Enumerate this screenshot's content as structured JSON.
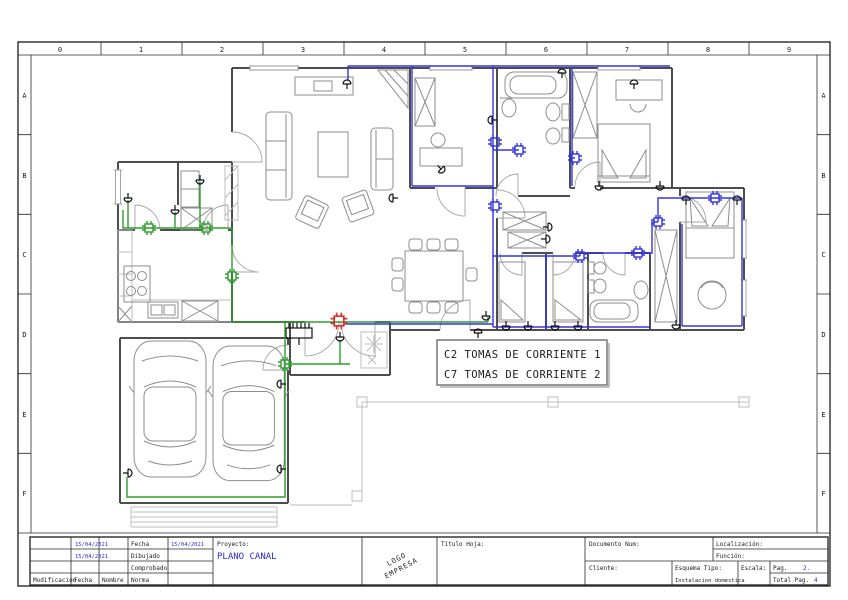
{
  "ruler": {
    "cols": [
      "0",
      "1",
      "2",
      "3",
      "4",
      "5",
      "6",
      "7",
      "8",
      "9"
    ],
    "rows": [
      "A",
      "B",
      "C",
      "D",
      "E",
      "F"
    ]
  },
  "legend": {
    "lines": [
      {
        "text": "C2 TOMAS DE CORRIENTE 1",
        "color": "#2e9e2e"
      },
      {
        "text": "C7 TOMAS DE CORRIENTE 2",
        "color": "#3535dd"
      }
    ]
  },
  "colors": {
    "circuit_c2": "#2e9e2e",
    "circuit_c7": "#3535dd",
    "panel_marker": "#d63030",
    "accent_blue": "#2a2ad4"
  },
  "title_block": {
    "revision": {
      "col_headers": [
        "Modificación",
        "Fecha",
        "Nombre"
      ],
      "dates": [
        "15/04/2021",
        "15/04/2021"
      ]
    },
    "approval": {
      "rows": [
        {
          "label": "Fecha",
          "value": "15/04/2021"
        },
        {
          "label": "Dibujado",
          "value": ""
        },
        {
          "label": "Comprobado",
          "value": ""
        },
        {
          "label": "Norma",
          "value": ""
        }
      ]
    },
    "project": {
      "label": "Proyecto:",
      "name": "PLANO CANAL"
    },
    "logo": {
      "line1": "LOGO",
      "line2": "EMPRESA"
    },
    "sheet_title_label": "Título Hoja:",
    "document_num_label": "Documento Num:",
    "location_label": "Localización:",
    "function_label": "Función:",
    "client_label": "Cliente:",
    "schema": {
      "label": "Esquema Tipo:",
      "value": "Instalacion domestica"
    },
    "scale_label": "Escala:",
    "page": {
      "label": "Pag.",
      "value": "2."
    },
    "total": {
      "label": "Total Pag.",
      "value": "4"
    }
  }
}
